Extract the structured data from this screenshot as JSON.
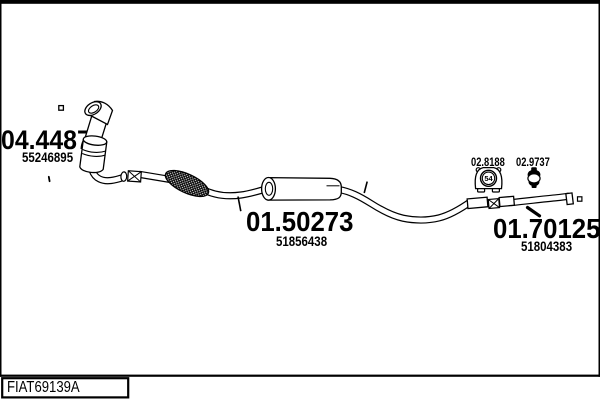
{
  "diagram": {
    "parts": [
      {
        "id": "catalyst",
        "code": "04.4487",
        "oe": "55246895"
      },
      {
        "id": "centre-silencer",
        "code": "01.50273",
        "oe": "51856438"
      },
      {
        "id": "rear-pipe",
        "code": "01.70125",
        "oe": "51804383"
      },
      {
        "id": "rubber-mount",
        "code": "02.8188",
        "badge": "54"
      },
      {
        "id": "clamp",
        "code": "02.9737"
      }
    ],
    "footer_id": "FIAT69139A"
  }
}
